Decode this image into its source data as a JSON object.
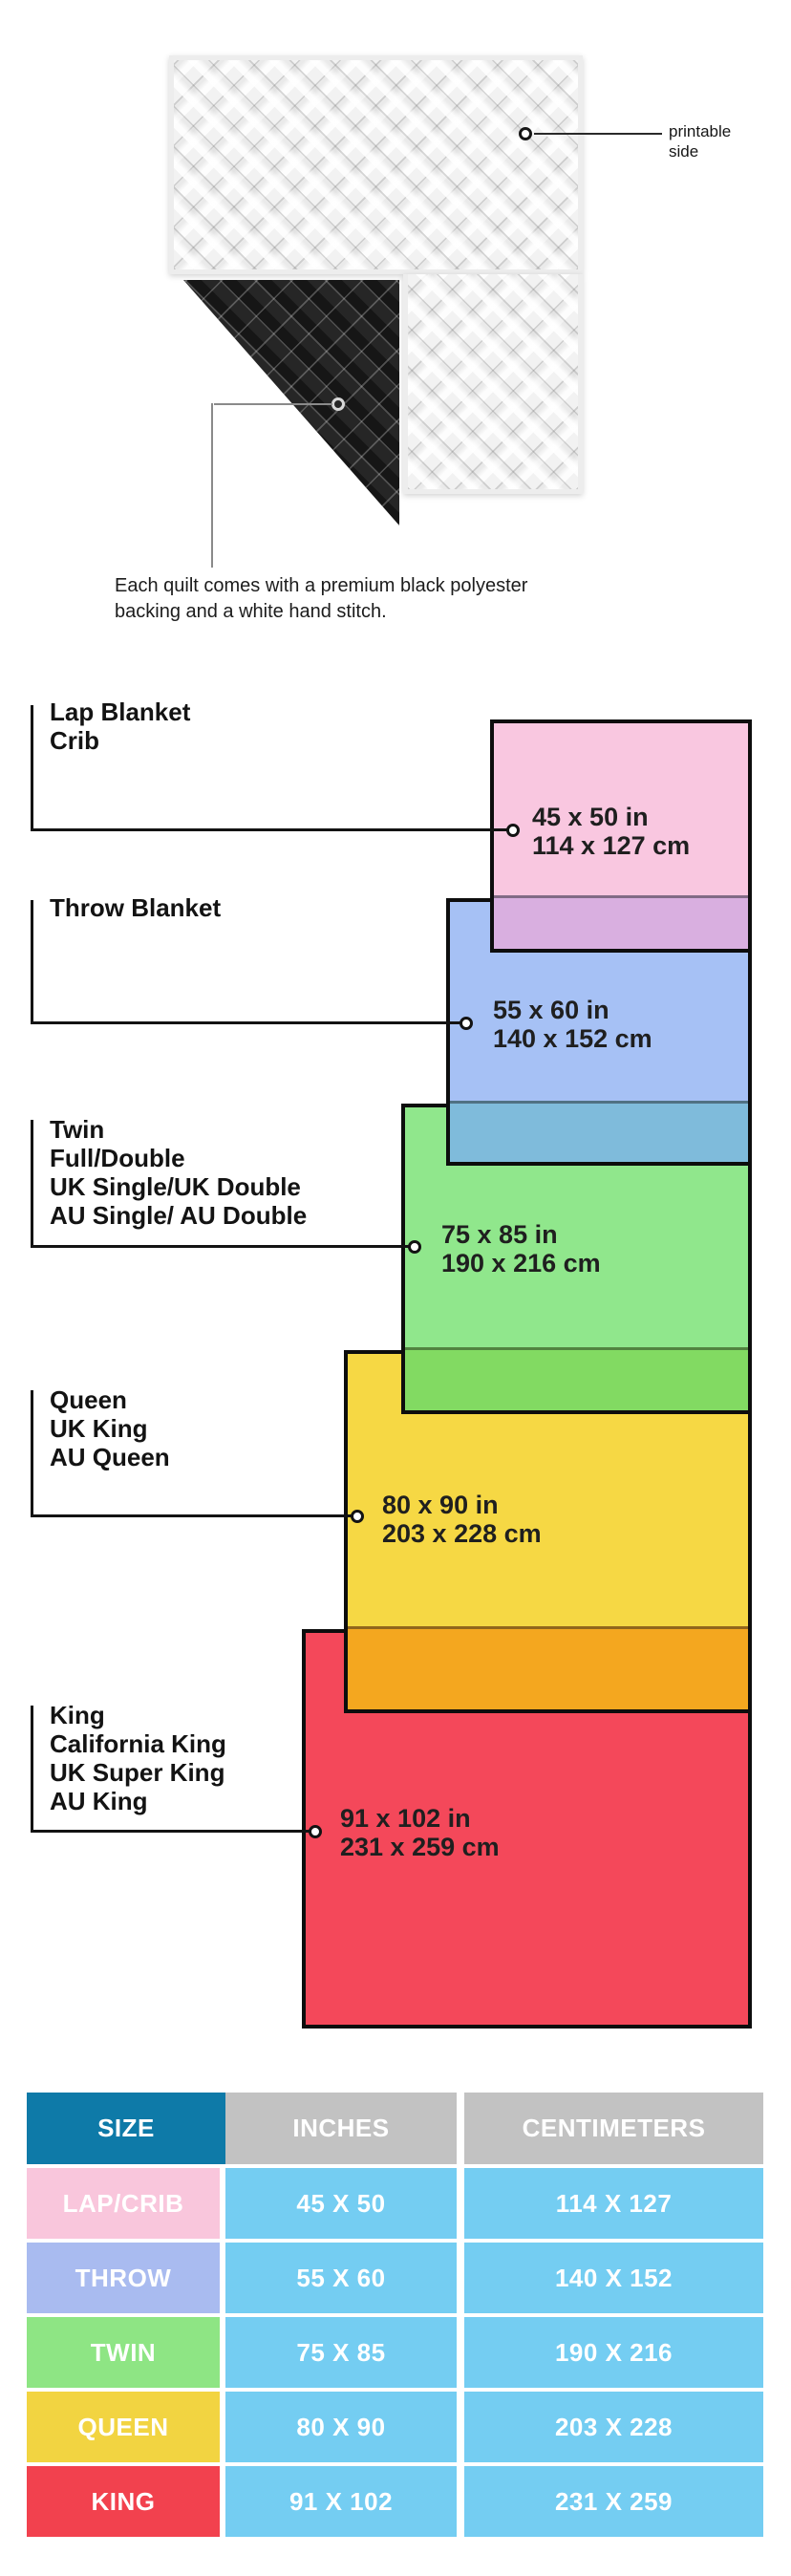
{
  "quilt": {
    "printable_label_line1": "printable",
    "printable_label_line2": "side",
    "caption_line1": "Each quilt comes with a premium black polyester",
    "caption_line2": "backing and a white hand stitch.",
    "top_side_color": "#f2f2f2",
    "backing_color": "#161616"
  },
  "diagram": {
    "sizes": [
      {
        "id": "lap",
        "labels": [
          "Lap Blanket",
          "Crib"
        ],
        "inches": "45 x 50 in",
        "cm": "114 x 127 cm",
        "color": "#f9c7e0",
        "overlap_color": "#d9afe0"
      },
      {
        "id": "throw",
        "labels": [
          "Throw Blanket"
        ],
        "inches": "55 x 60 in",
        "cm": "140 x 152 cm",
        "color": "#a6c1f5",
        "overlap_color": "#7fbbdb"
      },
      {
        "id": "twin",
        "labels": [
          "Twin",
          "Full/Double",
          "UK Single/UK Double",
          "AU Single/ AU Double"
        ],
        "inches": "75 x 85 in",
        "cm": "190 x 216 cm",
        "color": "#90e78c",
        "overlap_color": "#82da62"
      },
      {
        "id": "queen",
        "labels": [
          "Queen",
          "UK King",
          "AU Queen"
        ],
        "inches": "80 x 90 in",
        "cm": "203 x 228 cm",
        "color": "#f6d844",
        "overlap_color": "#f4a71f"
      },
      {
        "id": "king",
        "labels": [
          "King",
          "California King",
          "UK Super King",
          "AU King"
        ],
        "inches": "91 x 102 in",
        "cm": "231 x 259 cm",
        "color": "#f4485a",
        "overlap_color": ""
      }
    ]
  },
  "table": {
    "headers": [
      "SIZE",
      "INCHES",
      "CENTIMETERS"
    ],
    "header_size_bg": "#0e7aa8",
    "header_other_bg": "#c2c2c2",
    "data_cell_bg": "#74cdf2",
    "rows": [
      {
        "size": "LAP/CRIB",
        "inches": "45 X 50",
        "cm": "114 X 127",
        "size_bg": "#f9c6dc"
      },
      {
        "size": "THROW",
        "inches": "55 X 60",
        "cm": "140 X 152",
        "size_bg": "#a9bbf0"
      },
      {
        "size": "TWIN",
        "inches": "75 X 85",
        "cm": "190 X 216",
        "size_bg": "#8ee584"
      },
      {
        "size": "QUEEN",
        "inches": "80 X 90",
        "cm": "203 X 228",
        "size_bg": "#f2d441"
      },
      {
        "size": "KING",
        "inches": "91 X 102",
        "cm": "231 X 259",
        "size_bg": "#f2414e"
      }
    ]
  }
}
